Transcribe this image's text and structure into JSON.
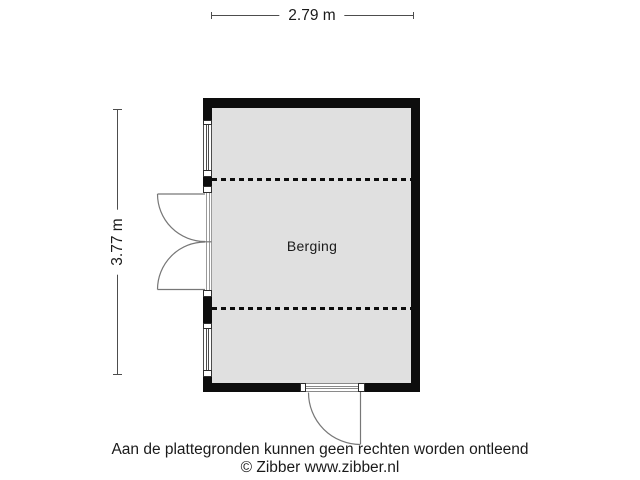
{
  "dimensions": {
    "width": {
      "label": "2.79 m"
    },
    "height": {
      "label": "3.77 m"
    }
  },
  "room": {
    "label": "Berging"
  },
  "footer": {
    "disclaimer": "Aan de plattegronden kunnen geen rechten worden ontleend",
    "copyright": "© Zibber www.zibber.nl"
  },
  "colors": {
    "wall": "#0d0d0d",
    "floor_fill": "#e0e0e0",
    "dimension_line": "#4d4d4d",
    "door_line": "#777777",
    "window_line": "#4d4d4d",
    "text": "#1a1a1a"
  }
}
